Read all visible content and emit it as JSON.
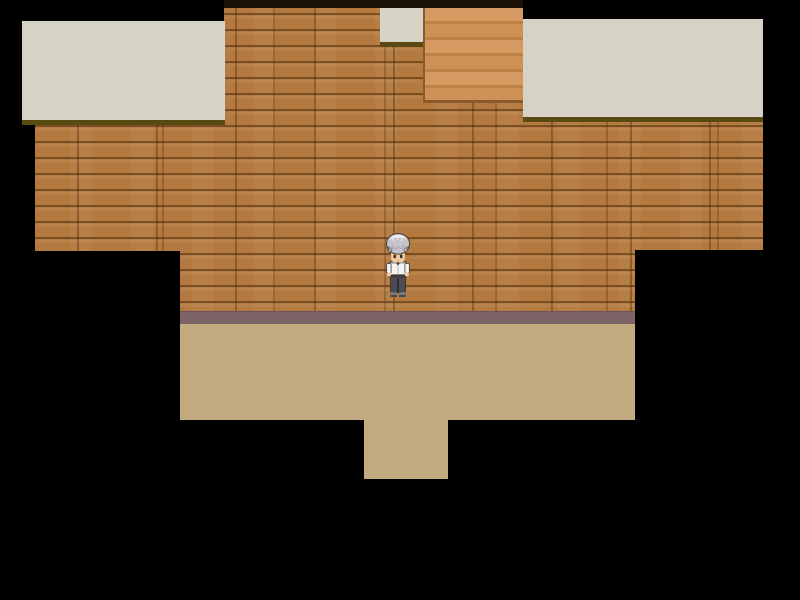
{
  "app": {
    "name": "RPG game screen",
    "view": "top-down interior map, RPG Maker style",
    "visible_text": []
  },
  "palette": {
    "bg": "#000000",
    "top_shade": "#1c1106",
    "wood": "#b3793f",
    "ceiling": "#d6d3c6",
    "eave": "#584a10",
    "stair": "#d49a61",
    "stair_line": "#bf8046",
    "stair_edge": "#8a5a2c",
    "baseboard": "#7c6366",
    "floor": "#c3ab81",
    "hair": "#c4c4c9",
    "hair_hi": "#ececf0",
    "hair_sh": "#8e8e96",
    "outline": "#45413f",
    "skin": "#f3c9a0",
    "skin_sh": "#d9a87c",
    "eye": "#2c2826",
    "shirt": "#f4f3f1",
    "shirt_sh": "#d9d8d4",
    "trim": "#3c3a3a",
    "pants": "#4d4b54",
    "pants_dk": "#312f36",
    "shoe": "#77767a"
  },
  "scene": {
    "background": "black void outside map bounds",
    "regions": [
      {
        "name": "wood-plank-wall",
        "description": "horizontal brown wooden planks",
        "color": "#b3793f"
      },
      {
        "name": "ceiling-tile-left",
        "description": "beige ceiling tile with olive shadow edge",
        "color": "#d6d3c6"
      },
      {
        "name": "ceiling-tile-right",
        "description": "beige ceiling tile with olive shadow edge",
        "color": "#d6d3c6"
      },
      {
        "name": "ceiling-notch-top-center",
        "description": "small beige tile notch at top center",
        "color": "#d6d3c6"
      },
      {
        "name": "stair-column",
        "description": "lighter banded wood column / stairs",
        "color": "#d49a61"
      },
      {
        "name": "baseboard",
        "description": "mauve-brown strip between wall and floor",
        "color": "#7c6366"
      },
      {
        "name": "floor",
        "description": "tan walkable floor with lower doorway protrusion",
        "color": "#c3ab81"
      }
    ],
    "character": {
      "role": "player",
      "hair": "silver gray",
      "shirt": "white with dark trim",
      "pants": "dark gray",
      "facing": "down"
    }
  }
}
